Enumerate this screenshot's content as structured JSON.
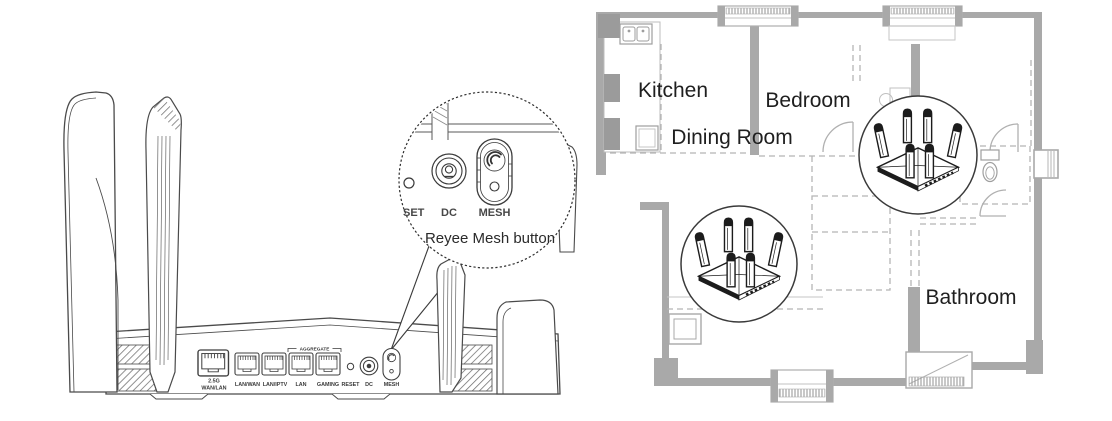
{
  "illustration": {
    "caption": "Reyee Mesh button",
    "magnifier_labels": {
      "reset_partial": "SET",
      "dc": "DC",
      "mesh": "MESH"
    },
    "rear_panel": {
      "aggregate": "AGGREGATE",
      "port1_line1": "2.5G",
      "port1_line2": "WAN/LAN",
      "port2": "LAN/WAN",
      "port3": "LAN/IPTV",
      "port4": "LAN",
      "port5": "GAMING",
      "reset": "RESET",
      "dc": "DC",
      "mesh": "MESH"
    }
  },
  "floorplan": {
    "rooms": {
      "kitchen": "Kitchen",
      "bedroom": "Bedroom",
      "dining": "Dining Room",
      "bathroom": "Bathroom"
    },
    "mesh_router_count": 2
  },
  "colors": {
    "wall_gray": "#a9a9a9",
    "line_dark": "#4a4a4a",
    "text_dark": "#1f1f1f"
  }
}
